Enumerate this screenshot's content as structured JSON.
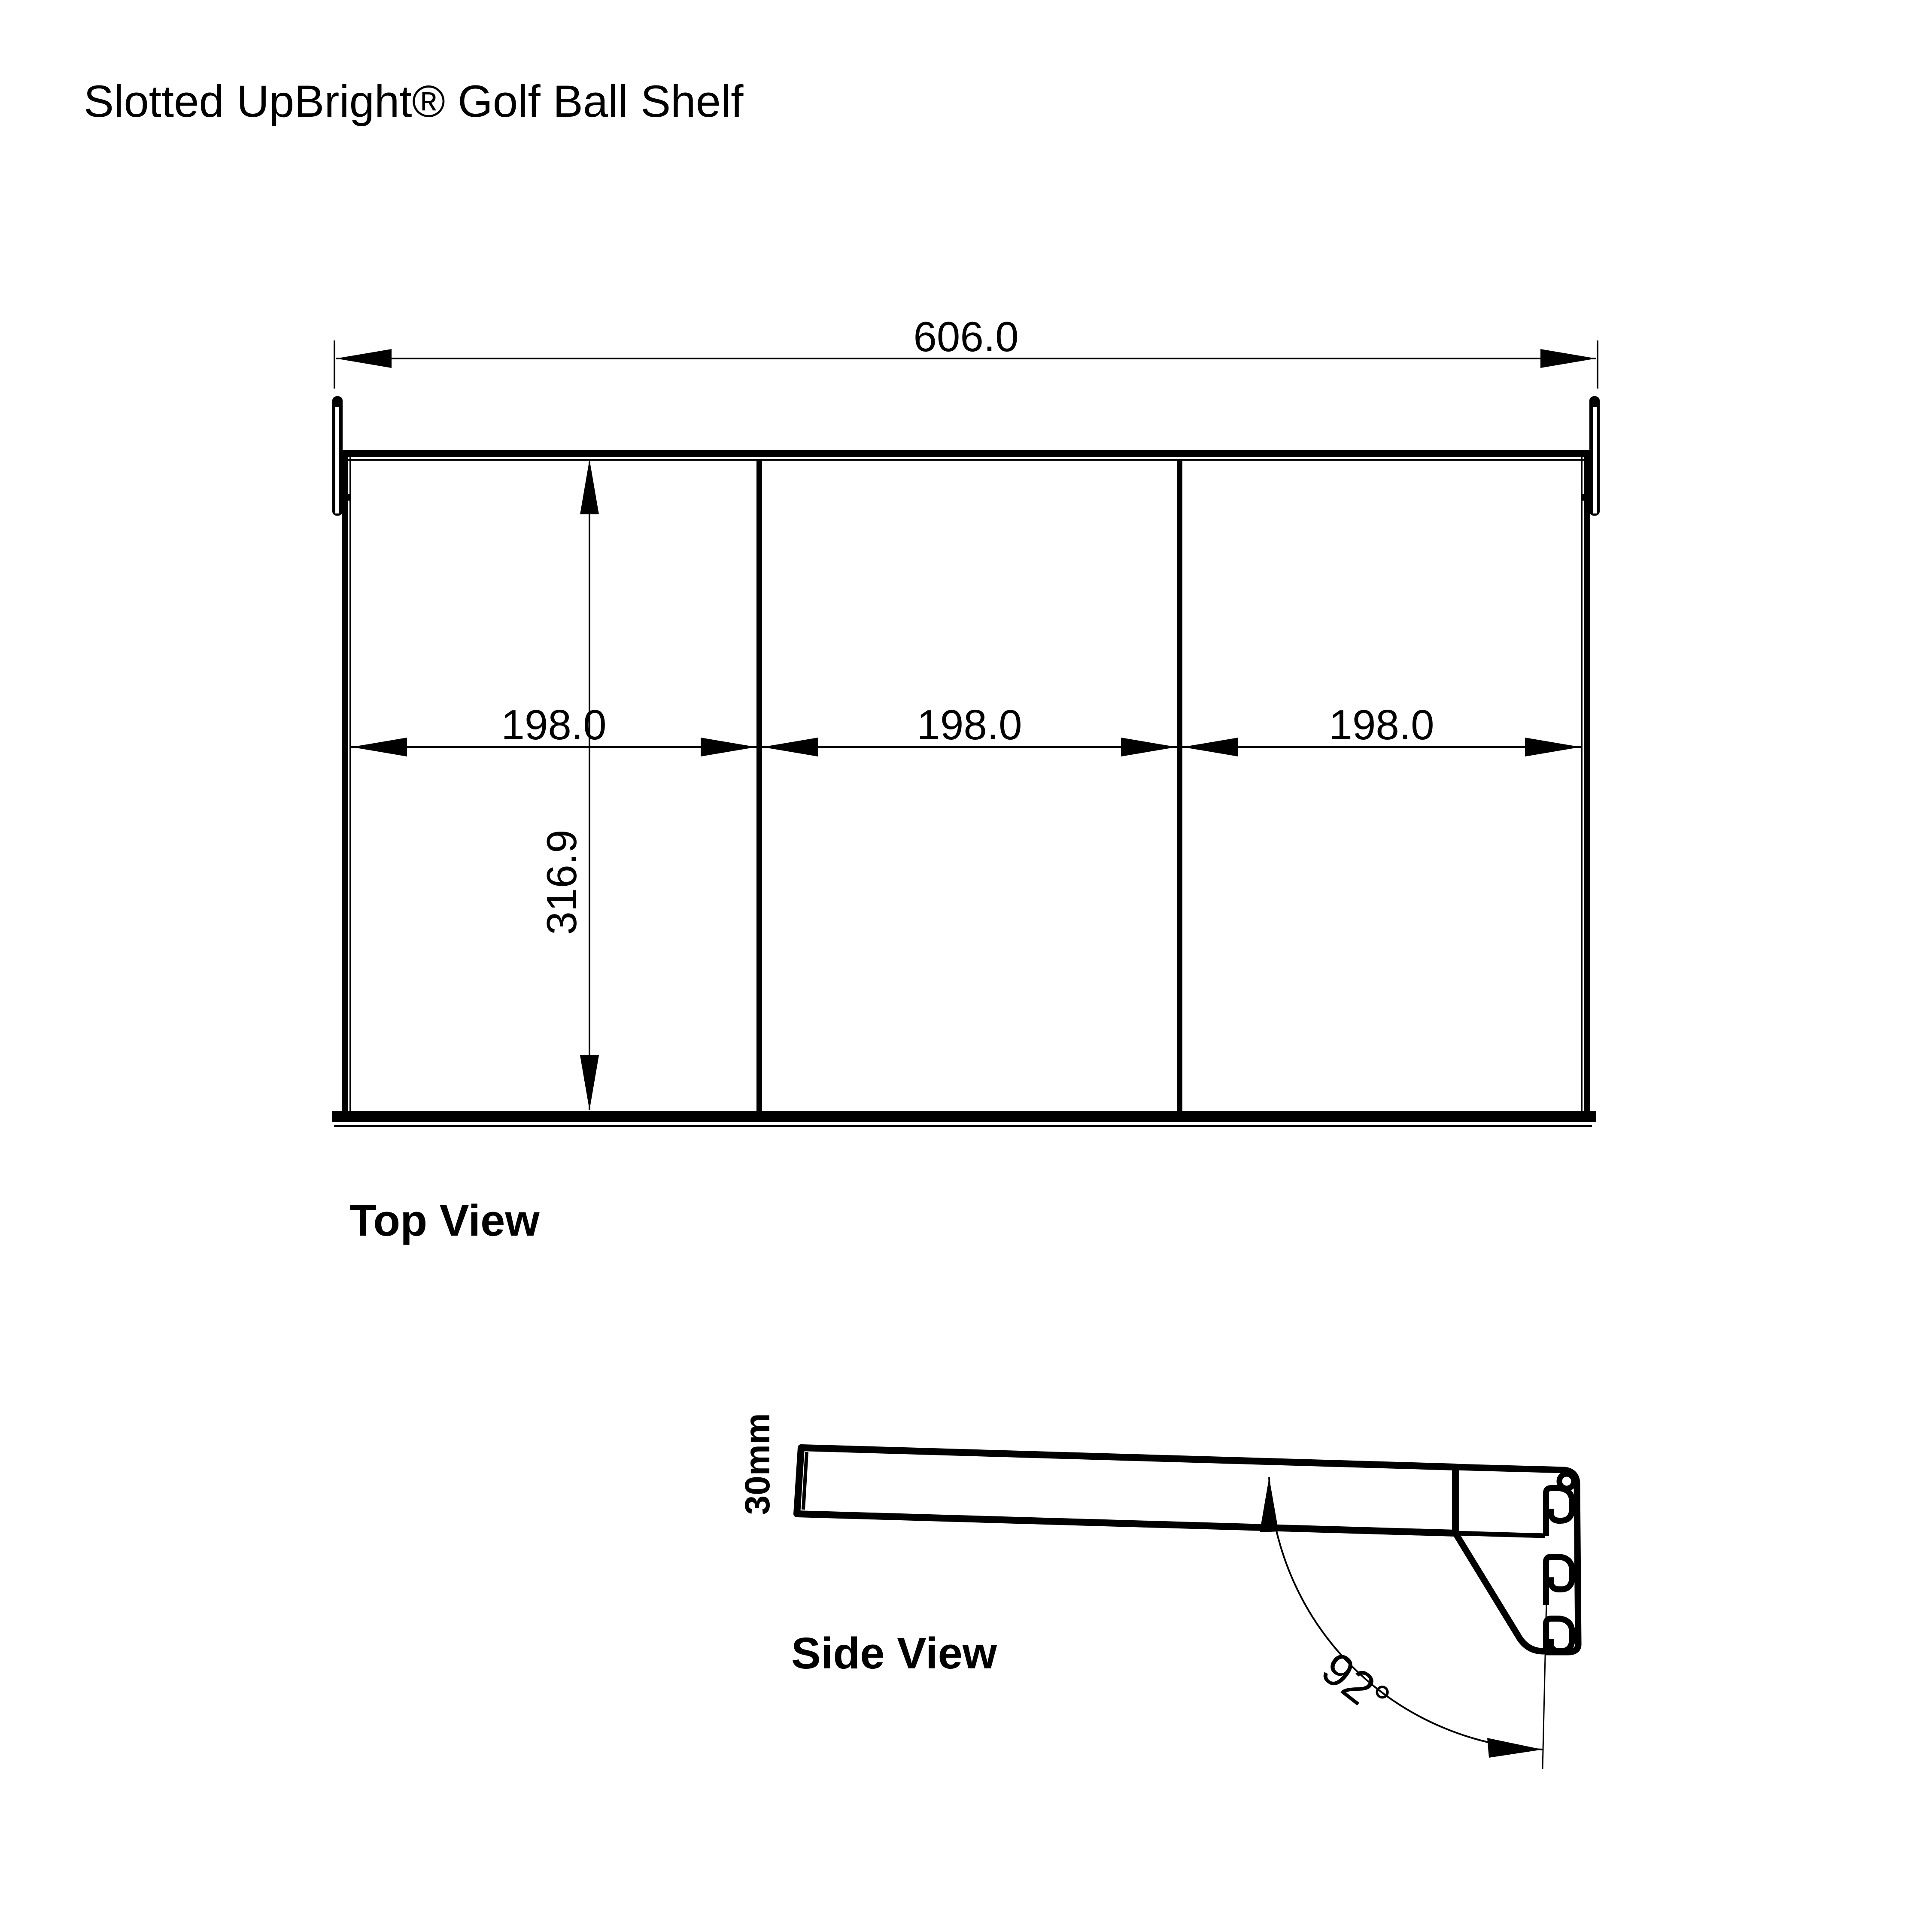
{
  "title": "Slotted UpBright® Golf Ball Shelf",
  "colors": {
    "ink": "#000000",
    "paper": "#ffffff"
  },
  "top_view": {
    "label": "Top View",
    "sections": 3,
    "dim_overall_width": "606.0",
    "dim_section_widths": [
      "198.0",
      "198.0",
      "198.0"
    ],
    "dim_depth": "316.9"
  },
  "side_view": {
    "label": "Side View",
    "dim_thickness": "30mm",
    "dim_bracket_angle": "92°"
  }
}
